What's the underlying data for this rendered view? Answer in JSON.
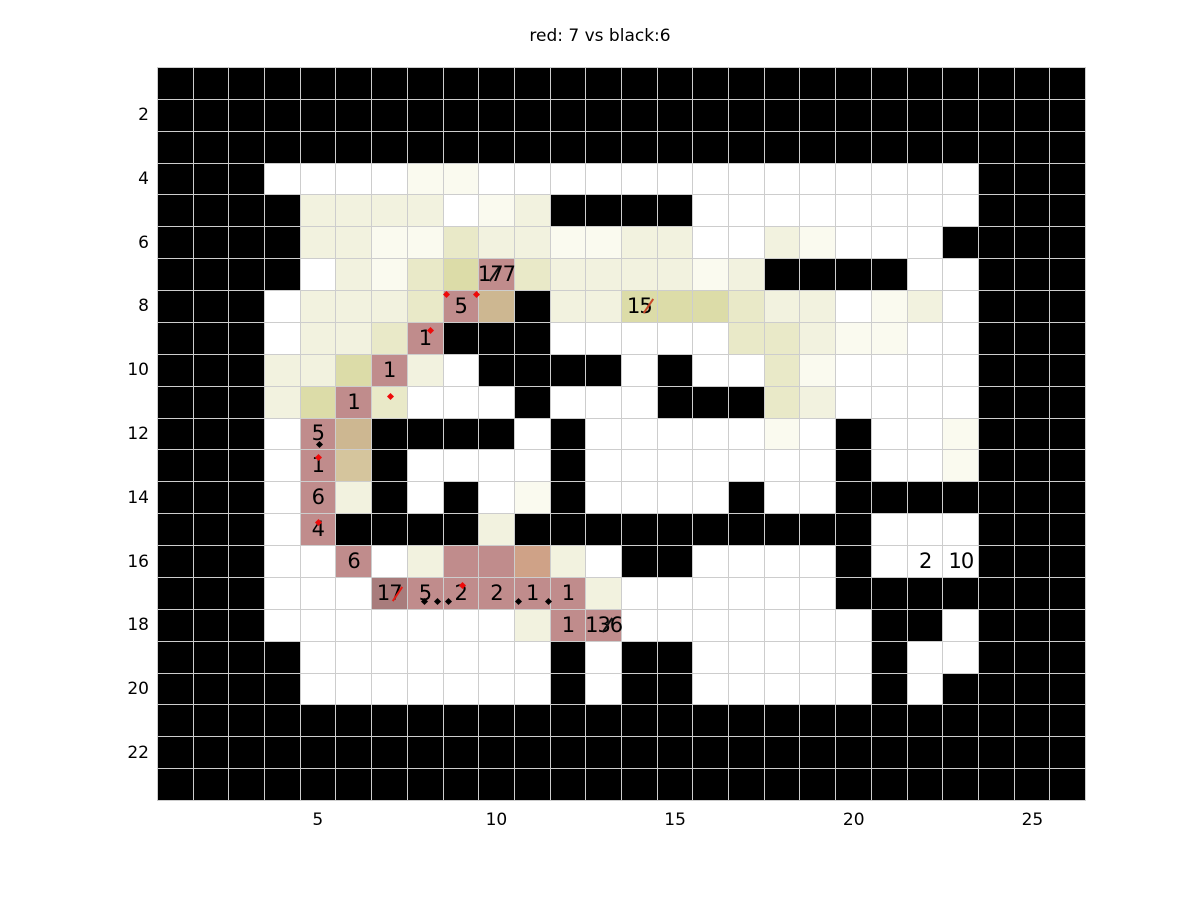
{
  "chart_data": {
    "type": "heatmap",
    "title": "red: 7 vs black:6",
    "xlabel": "",
    "ylabel": "",
    "x_ticks": [
      5,
      10,
      15,
      20,
      25
    ],
    "y_ticks": [
      2,
      4,
      6,
      8,
      10,
      12,
      14,
      16,
      18,
      20,
      22
    ],
    "n_cols": 26,
    "n_rows": 23,
    "grid_on": true,
    "legend": "none",
    "palette": {
      "k": "#000000",
      "w": "#ffffff",
      "a": "#fafaef",
      "b": "#f2f2df",
      "c": "#e9e9c8",
      "d": "#dcdca8",
      "e": "#cdb791",
      "f": "#d5c59d",
      "g": "#cfa287",
      "h": "#c08c8c",
      "i": "#a87c7c"
    },
    "grid": [
      [
        "k",
        "k",
        "k",
        "k",
        "k",
        "k",
        "k",
        "k",
        "k",
        "k",
        "k",
        "k",
        "k",
        "k",
        "k",
        "k",
        "k",
        "k",
        "k",
        "k",
        "k",
        "k",
        "k",
        "k",
        "k",
        "k"
      ],
      [
        "k",
        "k",
        "k",
        "k",
        "k",
        "k",
        "k",
        "k",
        "k",
        "k",
        "k",
        "k",
        "k",
        "k",
        "k",
        "k",
        "k",
        "k",
        "k",
        "k",
        "k",
        "k",
        "k",
        "k",
        "k",
        "k"
      ],
      [
        "k",
        "k",
        "k",
        "k",
        "k",
        "k",
        "k",
        "k",
        "k",
        "k",
        "k",
        "k",
        "k",
        "k",
        "k",
        "k",
        "k",
        "k",
        "k",
        "k",
        "k",
        "k",
        "k",
        "k",
        "k",
        "k"
      ],
      [
        "k",
        "k",
        "k",
        "w",
        "w",
        "w",
        "w",
        "a",
        "a",
        "w",
        "w",
        "w",
        "w",
        "w",
        "w",
        "w",
        "w",
        "w",
        "w",
        "w",
        "w",
        "w",
        "w",
        "k",
        "k",
        "k"
      ],
      [
        "k",
        "k",
        "k",
        "k",
        "b",
        "b",
        "b",
        "b",
        "w",
        "a",
        "b",
        "k",
        "k",
        "k",
        "k",
        "w",
        "w",
        "w",
        "w",
        "w",
        "w",
        "w",
        "w",
        "k",
        "k",
        "k"
      ],
      [
        "k",
        "k",
        "k",
        "k",
        "b",
        "b",
        "a",
        "a",
        "c",
        "b",
        "b",
        "a",
        "a",
        "b",
        "b",
        "w",
        "w",
        "b",
        "a",
        "w",
        "w",
        "w",
        "k",
        "k",
        "k",
        "k"
      ],
      [
        "k",
        "k",
        "k",
        "k",
        "w",
        "b",
        "a",
        "c",
        "d",
        "h",
        "c",
        "b",
        "b",
        "b",
        "b",
        "a",
        "b",
        "k",
        "k",
        "k",
        "k",
        "w",
        "w",
        "k",
        "k",
        "k"
      ],
      [
        "k",
        "k",
        "k",
        "w",
        "b",
        "b",
        "b",
        "c",
        "h",
        "e",
        "k",
        "b",
        "b",
        "d",
        "d",
        "d",
        "c",
        "b",
        "b",
        "w",
        "a",
        "b",
        "w",
        "k",
        "k",
        "k"
      ],
      [
        "k",
        "k",
        "k",
        "w",
        "b",
        "b",
        "c",
        "h",
        "k",
        "k",
        "k",
        "w",
        "w",
        "w",
        "w",
        "w",
        "c",
        "c",
        "b",
        "a",
        "a",
        "w",
        "w",
        "k",
        "k",
        "k"
      ],
      [
        "k",
        "k",
        "k",
        "b",
        "b",
        "d",
        "h",
        "b",
        "w",
        "k",
        "k",
        "k",
        "k",
        "w",
        "k",
        "w",
        "w",
        "c",
        "a",
        "w",
        "w",
        "w",
        "w",
        "k",
        "k",
        "k"
      ],
      [
        "k",
        "k",
        "k",
        "b",
        "d",
        "h",
        "c",
        "w",
        "w",
        "w",
        "k",
        "w",
        "w",
        "w",
        "k",
        "k",
        "k",
        "c",
        "b",
        "w",
        "w",
        "w",
        "w",
        "k",
        "k",
        "k"
      ],
      [
        "k",
        "k",
        "k",
        "w",
        "h",
        "e",
        "k",
        "k",
        "k",
        "k",
        "w",
        "k",
        "w",
        "w",
        "w",
        "w",
        "w",
        "a",
        "w",
        "k",
        "w",
        "w",
        "a",
        "k",
        "k",
        "k"
      ],
      [
        "k",
        "k",
        "k",
        "w",
        "h",
        "f",
        "k",
        "w",
        "w",
        "w",
        "w",
        "k",
        "w",
        "w",
        "w",
        "w",
        "w",
        "w",
        "w",
        "k",
        "w",
        "w",
        "a",
        "k",
        "k",
        "k"
      ],
      [
        "k",
        "k",
        "k",
        "w",
        "h",
        "b",
        "k",
        "w",
        "k",
        "w",
        "a",
        "k",
        "w",
        "w",
        "w",
        "w",
        "k",
        "w",
        "w",
        "k",
        "k",
        "k",
        "k",
        "k",
        "k",
        "k"
      ],
      [
        "k",
        "k",
        "k",
        "w",
        "h",
        "k",
        "k",
        "k",
        "k",
        "b",
        "k",
        "k",
        "k",
        "k",
        "k",
        "k",
        "k",
        "k",
        "k",
        "k",
        "w",
        "w",
        "w",
        "k",
        "k",
        "k"
      ],
      [
        "k",
        "k",
        "k",
        "w",
        "w",
        "h",
        "w",
        "b",
        "h",
        "h",
        "g",
        "b",
        "w",
        "k",
        "k",
        "w",
        "w",
        "w",
        "w",
        "k",
        "w",
        "w",
        "w",
        "k",
        "k",
        "k"
      ],
      [
        "k",
        "k",
        "k",
        "w",
        "w",
        "w",
        "i",
        "h",
        "h",
        "h",
        "h",
        "h",
        "b",
        "w",
        "w",
        "w",
        "w",
        "w",
        "w",
        "k",
        "k",
        "k",
        "k",
        "k",
        "k",
        "k"
      ],
      [
        "k",
        "k",
        "k",
        "w",
        "w",
        "w",
        "w",
        "w",
        "w",
        "w",
        "b",
        "h",
        "h",
        "w",
        "w",
        "w",
        "w",
        "w",
        "w",
        "w",
        "k",
        "k",
        "w",
        "k",
        "k",
        "k"
      ],
      [
        "k",
        "k",
        "k",
        "k",
        "w",
        "w",
        "w",
        "w",
        "w",
        "w",
        "w",
        "k",
        "w",
        "k",
        "k",
        "w",
        "w",
        "w",
        "w",
        "w",
        "k",
        "w",
        "w",
        "k",
        "k",
        "k"
      ],
      [
        "k",
        "k",
        "k",
        "k",
        "w",
        "w",
        "w",
        "w",
        "w",
        "w",
        "w",
        "k",
        "w",
        "k",
        "k",
        "w",
        "w",
        "w",
        "w",
        "w",
        "k",
        "w",
        "k",
        "k",
        "k",
        "k"
      ],
      [
        "k",
        "k",
        "k",
        "k",
        "k",
        "k",
        "k",
        "k",
        "k",
        "k",
        "k",
        "k",
        "k",
        "k",
        "k",
        "k",
        "k",
        "k",
        "k",
        "k",
        "k",
        "k",
        "k",
        "k",
        "k",
        "k"
      ],
      [
        "k",
        "k",
        "k",
        "k",
        "k",
        "k",
        "k",
        "k",
        "k",
        "k",
        "k",
        "k",
        "k",
        "k",
        "k",
        "k",
        "k",
        "k",
        "k",
        "k",
        "k",
        "k",
        "k",
        "k",
        "k",
        "k"
      ],
      [
        "k",
        "k",
        "k",
        "k",
        "k",
        "k",
        "k",
        "k",
        "k",
        "k",
        "k",
        "k",
        "k",
        "k",
        "k",
        "k",
        "k",
        "k",
        "k",
        "k",
        "k",
        "k",
        "k",
        "k",
        "k",
        "k"
      ]
    ],
    "cell_labels": [
      {
        "r": 7,
        "c": 10,
        "text": "177",
        "slash": "#111111",
        "slash_x": 0.22
      },
      {
        "r": 8,
        "c": 9,
        "text": "5",
        "slash": null,
        "slash_x": 0
      },
      {
        "r": 8,
        "c": 14,
        "text": "15",
        "slash": "#c84828",
        "slash_x": 0.52
      },
      {
        "r": 9,
        "c": 8,
        "text": "1",
        "slash": null,
        "slash_x": 0
      },
      {
        "r": 10,
        "c": 7,
        "text": "1",
        "slash": null,
        "slash_x": 0
      },
      {
        "r": 11,
        "c": 6,
        "text": "1",
        "slash": null,
        "slash_x": 0
      },
      {
        "r": 12,
        "c": 5,
        "text": "5",
        "slash": null,
        "slash_x": 0
      },
      {
        "r": 13,
        "c": 5,
        "text": "1",
        "slash": null,
        "slash_x": 0
      },
      {
        "r": 14,
        "c": 5,
        "text": "6",
        "slash": null,
        "slash_x": 0
      },
      {
        "r": 15,
        "c": 5,
        "text": "4",
        "slash": null,
        "slash_x": 0
      },
      {
        "r": 16,
        "c": 6,
        "text": "6",
        "slash": null,
        "slash_x": 0
      },
      {
        "r": 16,
        "c": 22,
        "text": "2",
        "slash": null,
        "slash_x": 0
      },
      {
        "r": 16,
        "c": 23,
        "text": "10",
        "slash": null,
        "slash_x": 0
      },
      {
        "r": 17,
        "c": 7,
        "text": "17",
        "slash": "#e81c14",
        "slash_x": 0.5
      },
      {
        "r": 17,
        "c": 8,
        "text": "5",
        "slash": null,
        "slash_x": 0
      },
      {
        "r": 17,
        "c": 9,
        "text": "2",
        "slash": null,
        "slash_x": 0
      },
      {
        "r": 17,
        "c": 10,
        "text": "2",
        "slash": null,
        "slash_x": 0
      },
      {
        "r": 17,
        "c": 11,
        "text": "1",
        "slash": null,
        "slash_x": 0
      },
      {
        "r": 17,
        "c": 12,
        "text": "1",
        "slash": null,
        "slash_x": 0
      },
      {
        "r": 18,
        "c": 12,
        "text": "1",
        "slash": null,
        "slash_x": 0
      },
      {
        "r": 18,
        "c": 13,
        "text": "136",
        "slash": "#111111",
        "slash_x": 0.38
      }
    ],
    "markers": [
      {
        "r": 8,
        "c": 9,
        "x": 0.04,
        "y": 0.06,
        "color": "#ee0a0a"
      },
      {
        "r": 8,
        "c": 9,
        "x": 0.86,
        "y": 0.06,
        "color": "#ee0a0a"
      },
      {
        "r": 9,
        "c": 8,
        "x": 0.58,
        "y": 0.18,
        "color": "#ee0a0a"
      },
      {
        "r": 11,
        "c": 7,
        "x": 0.46,
        "y": 0.24,
        "color": "#ee0a0a"
      },
      {
        "r": 13,
        "c": 5,
        "x": 0.46,
        "y": 0.16,
        "color": "#ee0a0a"
      },
      {
        "r": 15,
        "c": 5,
        "x": 0.46,
        "y": 0.2,
        "color": "#ee0a0a"
      },
      {
        "r": 17,
        "c": 9,
        "x": 0.47,
        "y": 0.18,
        "color": "#ee0a0a"
      },
      {
        "r": 12,
        "c": 5,
        "x": 0.49,
        "y": 0.74,
        "color": "#000000"
      },
      {
        "r": 17,
        "c": 8,
        "x": 0.42,
        "y": 0.68,
        "color": "#000000"
      },
      {
        "r": 17,
        "c": 8,
        "x": 0.78,
        "y": 0.68,
        "color": "#000000"
      },
      {
        "r": 17,
        "c": 9,
        "x": 0.08,
        "y": 0.68,
        "color": "#000000"
      },
      {
        "r": 17,
        "c": 11,
        "x": 0.05,
        "y": 0.68,
        "color": "#000000"
      },
      {
        "r": 17,
        "c": 12,
        "x": -0.11,
        "y": 0.68,
        "color": "#000000"
      }
    ]
  }
}
